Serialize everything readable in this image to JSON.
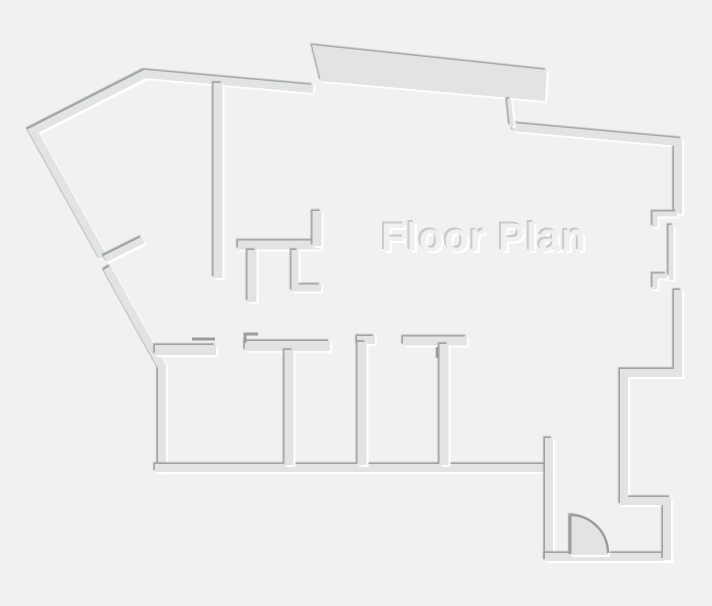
{
  "title": "Floor Plan",
  "canvas": {
    "width": 712,
    "height": 606
  },
  "colors": {
    "background": "#f0f1f1",
    "wall_fill": "#e1e3e4",
    "wall_shadow_dark": "#9a9c9e",
    "wall_highlight": "#ffffff",
    "text_fill": "#eff0f0",
    "text_shadow_dark": "#c7c9ca",
    "text_highlight": "#ffffff"
  },
  "walls": {
    "outer_nw_diagonals": "M 103 257 L 33 131 L 145 74 L 313 89",
    "outer_sw_diagonal_and_left": "M 107 268 L 162 367 L 162 472",
    "rooms_bottom": "M 155 468 L 549 468",
    "vestibule_left": "M 549 438 L 549 561",
    "vestibule_bottom": "M 545 557 L 671 557",
    "vestibule_right_and_jog": "M 667 560 L 667 501 L 624 501 L 624 373 L 678 373 L 678 290",
    "outer_ne_and_right_top": "M 513 127 L 678 142 L 678 214",
    "slab_connector": "M 509 99 L 512 126",
    "hall_vertical": "M 218 83 L 218 278",
    "closet_horizontal": "M 238 245 L 321 245",
    "closet_up_stub": "M 317 246 L 317 211",
    "closet_down_stub_a": "M 252 250 L 252 302",
    "closet_down_stub_b": "M 295 250 L 295 288 L 321 288",
    "roomtop_1": "M 155 350 L 216 350",
    "roomtop_2": "M 245 346 L 330 346",
    "roomtop_3": "M 357 340 L 375 340",
    "roomtop_4": "M 403 341 L 467 341",
    "divider_1": "M 289 350 L 289 465",
    "divider_2": "M 362 342 L 362 465",
    "divider_3": "M 444 344 L 444 465",
    "window_bracket_top": "M 677 214 L 655 214 L 655 227",
    "window_mid_wall": "M 671 225 L 671 280",
    "window_bracket_bottom": "M 667 276 L 655 276 L 655 289",
    "nw_door_leaf": "M 105 259 L 143 240"
  },
  "shapes": {
    "top_slab": "M 312 45 L 547 70 L 545 101 L 321 81 Z"
  },
  "thin_lines": {
    "window_lintel": "M 192 339 L 215 339",
    "jamb_step": "M 245 343 L 245 334 L 258 334",
    "divider3_jamb": "M 437 347 L 437 358"
  },
  "entry_door": {
    "swing_sector": "M 570 555 L 570 515 A 38 38 0 0 1 608 553 L 608 555 Z",
    "swing_arc": "M 570 515 A 38 38 0 0 1 608 553",
    "leaf": "M 570 554 L 570 516"
  },
  "title_pos": {
    "x": 484,
    "y": 251
  }
}
